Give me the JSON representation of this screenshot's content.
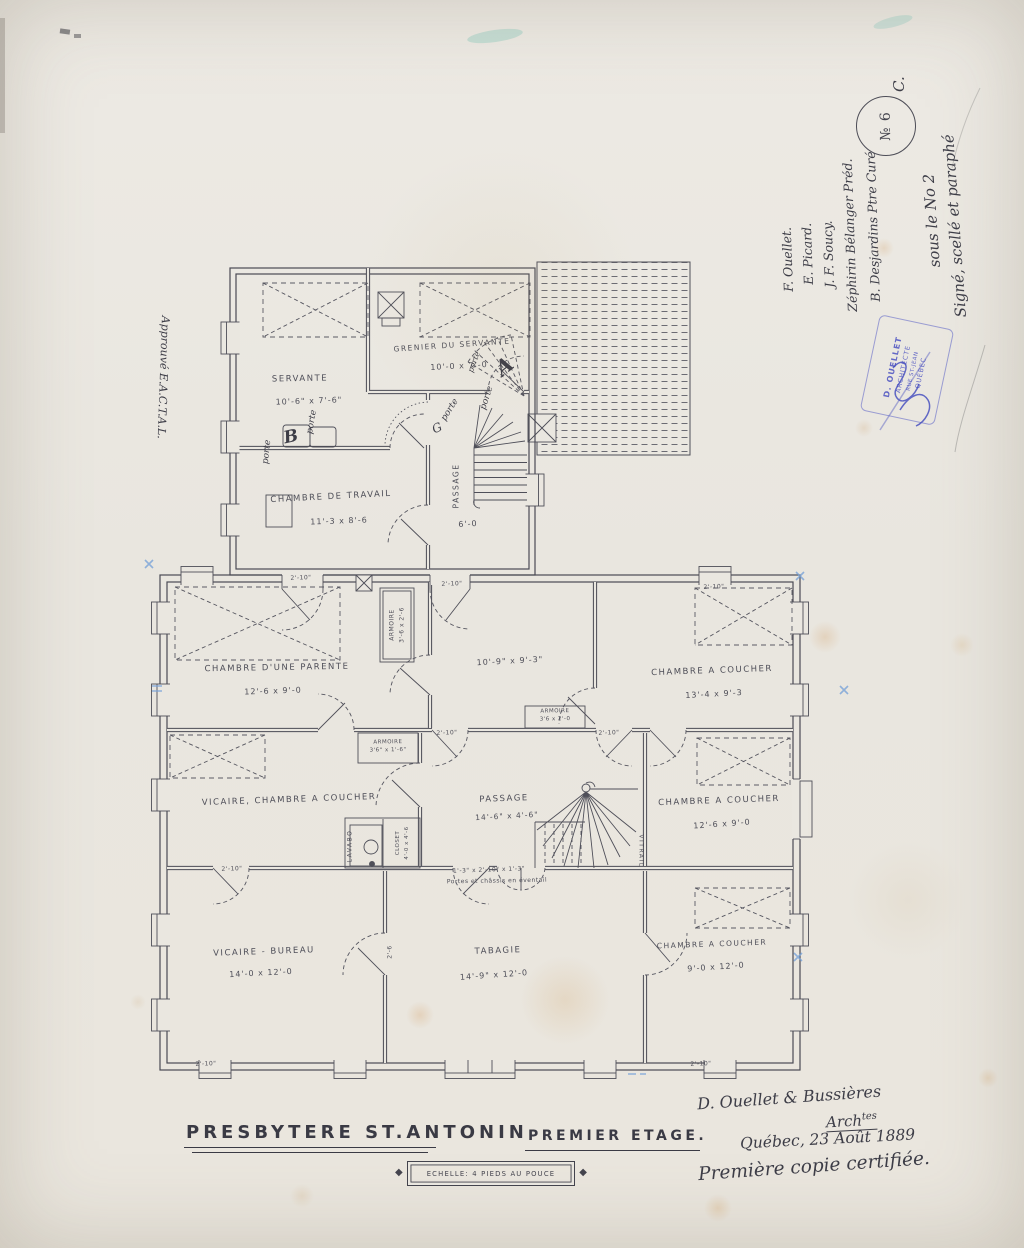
{
  "titleblock": {
    "title": "PRESBYTERE ST.ANTONIN",
    "floor": "PREMIER ETAGE.",
    "scale": "ECHELLE: 4 PIEDS AU POUCE"
  },
  "signoff": {
    "firm": "D. Ouellet & Bussières",
    "abbr": "Arch",
    "abbr_sup": "tes",
    "place_date": "Québec, 23 Août 1889",
    "certification": "Première copie certifiée."
  },
  "registry": {
    "seal_note_1": "Signé, scellé et paraphé",
    "seal_note_2": "sous le No 2",
    "letter": "C.",
    "number": "№ 6",
    "witnesses": [
      "B. Desjardins Ptre Curé",
      "Zéphirin Bélanger Préd.",
      "J. F. Soucy.",
      "E. Picard.",
      "F. Ouellet."
    ],
    "approval": "Approuvé E.A.C.T.A.L.",
    "stamp_lines": [
      "D. OUELLET",
      "ARCHITECTE",
      "RUE ST-JEAN",
      "QUÉBEC"
    ]
  },
  "rooms": {
    "servante": {
      "name": "SERVANTE",
      "dims": "10'-6\" x 7'-6\""
    },
    "grenier": {
      "name": "GRENIER DU SERVANTE",
      "dims": "10'-0 x 7'-0"
    },
    "travail": {
      "name": "CHAMBRE DE TRAVAIL",
      "dims": "11'-3 x 8'-6"
    },
    "passage_haut": {
      "name": "PASSAGE",
      "dims": "6'-0"
    },
    "parente": {
      "name": "CHAMBRE D'UNE PARENTE",
      "dims": "12'-6 x 9'-0"
    },
    "chambre_centre": {
      "name": "",
      "dims": "10'-9\" x 9'-3\""
    },
    "coucher_ne": {
      "name": "CHAMBRE A COUCHER",
      "dims": "13'-4 x 9'-3"
    },
    "vicaire_chambre": {
      "name": "VICAIRE, CHAMBRE A COUCHER",
      "dims": ""
    },
    "passage": {
      "name": "PASSAGE",
      "dims": "14'-6\" x 4'-6\""
    },
    "coucher_est": {
      "name": "CHAMBRE A COUCHER",
      "dims": "12'-6 x 9'-0"
    },
    "bureau": {
      "name": "VICAIRE - BUREAU",
      "dims": "14'-0 x 12'-0"
    },
    "tabagie": {
      "name": "TABAGIE",
      "dims": "14'-9\" x 12'-0"
    },
    "coucher_se": {
      "name": "CHAMBRE A COUCHER",
      "dims": "9'-0 x 12'-0"
    }
  },
  "closets": {
    "armoire_haut": {
      "name": "ARMOIRE",
      "dims": "3'-6 x 2'-6"
    },
    "armoire_centre": {
      "name": "ARMOIRE",
      "dims": "3'6 x 2'-0"
    },
    "armoire_vicaire": {
      "name": "ARMOIRE",
      "dims": "3'6\" x 1'-6\""
    },
    "closet": {
      "name": "CLOSET",
      "dims": "4'-0 x 4'-6"
    },
    "lavabo": "LAVABO",
    "vitrail": "VITRAIL"
  },
  "notes": {
    "fan_dims": "1'-3\" x 2'-10\" x 1'-3\"",
    "fan_note": "Portes et châssis en éventail",
    "dim_2_10": "2'-10\"",
    "dim_2_6": "2'-6",
    "porte": "porte",
    "letter_a": "A",
    "letter_b": "B",
    "letter_g": "G"
  }
}
